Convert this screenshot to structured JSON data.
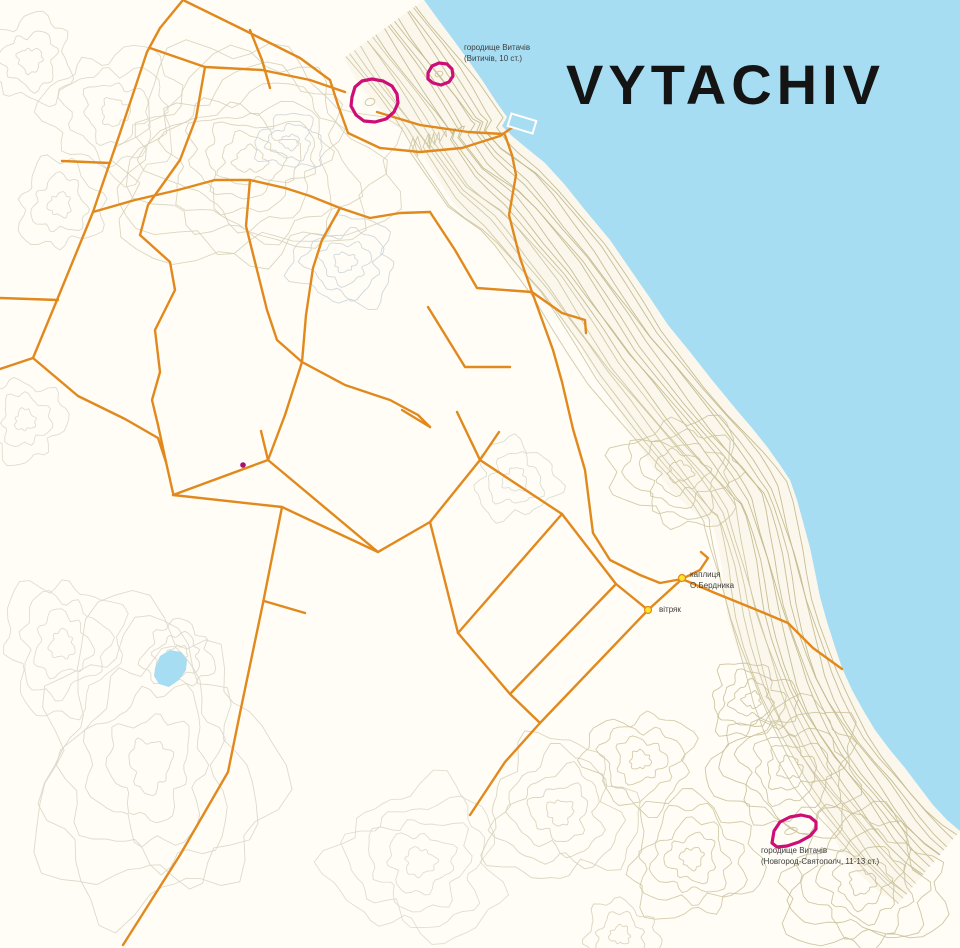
{
  "title": "VYTACHIV",
  "labels": {
    "site_north": {
      "line1": "городище Витачів",
      "line2": "(Витичів, 10 ст.)"
    },
    "chapel": {
      "line1": "каплиця",
      "line2": "О.Бердника"
    },
    "windmill": {
      "line1": "вітряк"
    },
    "site_south": {
      "line1": "городище Витачів",
      "line2": "(Новгород-Святополч, 11-13 ст.)"
    }
  },
  "colors": {
    "water": "#a7ddf2",
    "land": "#fffdf6",
    "coast_tint": "#f7f2e2",
    "contour_olive": "#c3ba8e",
    "contour_olive_light": "#cfc7a2",
    "road_orange": "#e1891d",
    "site_magenta": "#cc0e76",
    "poi_yellow": "#f9e62c",
    "dot_magenta": "#a8117a",
    "title_black": "#141414",
    "label_gray": "#3d3d3d"
  },
  "map": {
    "coast": [
      [
        424,
        0
      ],
      [
        437,
        18
      ],
      [
        452,
        38
      ],
      [
        468,
        60
      ],
      [
        482,
        80
      ],
      [
        497,
        103
      ],
      [
        507,
        117
      ],
      [
        502,
        126
      ],
      [
        512,
        136
      ],
      [
        524,
        146
      ],
      [
        545,
        163
      ],
      [
        565,
        185
      ],
      [
        585,
        210
      ],
      [
        610,
        240
      ],
      [
        632,
        272
      ],
      [
        650,
        298
      ],
      [
        668,
        325
      ],
      [
        690,
        352
      ],
      [
        712,
        380
      ],
      [
        735,
        408
      ],
      [
        752,
        428
      ],
      [
        768,
        448
      ],
      [
        780,
        465
      ],
      [
        790,
        480
      ],
      [
        797,
        500
      ],
      [
        803,
        522
      ],
      [
        810,
        548
      ],
      [
        815,
        572
      ],
      [
        820,
        597
      ],
      [
        827,
        622
      ],
      [
        835,
        647
      ],
      [
        842,
        668
      ],
      [
        852,
        690
      ],
      [
        863,
        710
      ],
      [
        875,
        730
      ],
      [
        890,
        750
      ],
      [
        905,
        768
      ],
      [
        920,
        788
      ],
      [
        933,
        805
      ],
      [
        947,
        820
      ],
      [
        960,
        831
      ]
    ],
    "pier": {
      "x": 509,
      "y": 117,
      "w": 26,
      "h": 13,
      "rot": 17
    },
    "lake": [
      [
        155,
        668
      ],
      [
        160,
        656
      ],
      [
        170,
        650
      ],
      [
        181,
        652
      ],
      [
        187,
        660
      ],
      [
        186,
        670
      ],
      [
        179,
        680
      ],
      [
        169,
        687
      ],
      [
        159,
        684
      ],
      [
        154,
        676
      ]
    ],
    "roads": [
      [
        [
          183,
          0
        ],
        [
          160,
          28
        ],
        [
          147,
          52
        ],
        [
          120,
          133
        ],
        [
          93,
          212
        ],
        [
          57,
          300
        ],
        [
          33,
          358
        ],
        [
          0,
          369
        ]
      ],
      [
        [
          33,
          358
        ],
        [
          78,
          396
        ],
        [
          125,
          419
        ],
        [
          158,
          438
        ],
        [
          166,
          462
        ],
        [
          173,
          493
        ]
      ],
      [
        [
          183,
          0
        ],
        [
          240,
          28
        ],
        [
          300,
          58
        ],
        [
          330,
          80
        ],
        [
          338,
          105
        ],
        [
          348,
          133
        ],
        [
          380,
          148
        ],
        [
          420,
          152
        ],
        [
          462,
          148
        ],
        [
          500,
          136
        ],
        [
          513,
          127
        ]
      ],
      [
        [
          377,
          112
        ],
        [
          420,
          125
        ],
        [
          468,
          132
        ],
        [
          503,
          134
        ]
      ],
      [
        [
          505,
          135
        ],
        [
          512,
          155
        ],
        [
          516,
          175
        ],
        [
          509,
          215
        ],
        [
          520,
          258
        ],
        [
          532,
          292
        ]
      ],
      [
        [
          150,
          48
        ],
        [
          205,
          67
        ],
        [
          262,
          70
        ],
        [
          310,
          80
        ],
        [
          345,
          92
        ]
      ],
      [
        [
          250,
          30
        ],
        [
          262,
          60
        ],
        [
          270,
          88
        ]
      ],
      [
        [
          205,
          67
        ],
        [
          196,
          118
        ],
        [
          180,
          160
        ],
        [
          148,
          205
        ],
        [
          140,
          235
        ],
        [
          170,
          262
        ],
        [
          175,
          290
        ],
        [
          155,
          330
        ],
        [
          160,
          372
        ],
        [
          152,
          400
        ],
        [
          158,
          425
        ],
        [
          166,
          462
        ]
      ],
      [
        [
          110,
          163
        ],
        [
          62,
          161
        ]
      ],
      [
        [
          58,
          300
        ],
        [
          0,
          298
        ]
      ],
      [
        [
          93,
          212
        ],
        [
          135,
          200
        ],
        [
          178,
          190
        ],
        [
          215,
          180
        ],
        [
          250,
          180
        ],
        [
          285,
          188
        ],
        [
          310,
          196
        ],
        [
          340,
          208
        ],
        [
          370,
          218
        ],
        [
          400,
          213
        ],
        [
          430,
          212
        ]
      ],
      [
        [
          250,
          180
        ],
        [
          246,
          226
        ],
        [
          257,
          270
        ],
        [
          267,
          310
        ],
        [
          277,
          340
        ],
        [
          302,
          362
        ]
      ],
      [
        [
          340,
          208
        ],
        [
          322,
          240
        ],
        [
          313,
          268
        ],
        [
          306,
          315
        ],
        [
          302,
          362
        ],
        [
          285,
          415
        ],
        [
          268,
          460
        ]
      ],
      [
        [
          302,
          362
        ],
        [
          345,
          385
        ],
        [
          390,
          400
        ],
        [
          418,
          415
        ],
        [
          430,
          427
        ]
      ],
      [
        [
          430,
          212
        ],
        [
          455,
          250
        ],
        [
          477,
          288
        ],
        [
          532,
          292
        ]
      ],
      [
        [
          532,
          292
        ],
        [
          562,
          313
        ],
        [
          585,
          320
        ],
        [
          586,
          333
        ]
      ],
      [
        [
          428,
          307
        ],
        [
          465,
          367
        ],
        [
          510,
          367
        ]
      ],
      [
        [
          402,
          410
        ],
        [
          430,
          427
        ]
      ],
      [
        [
          457,
          412
        ],
        [
          480,
          460
        ]
      ],
      [
        [
          532,
          292
        ],
        [
          553,
          350
        ],
        [
          562,
          382
        ],
        [
          573,
          429
        ],
        [
          585,
          470
        ],
        [
          593,
          533
        ],
        [
          610,
          560
        ],
        [
          640,
          575
        ],
        [
          660,
          583
        ],
        [
          682,
          579
        ]
      ],
      [
        [
          682,
          579
        ],
        [
          700,
          570
        ],
        [
          708,
          558
        ],
        [
          701,
          552
        ]
      ],
      [
        [
          682,
          579
        ],
        [
          715,
          593
        ],
        [
          757,
          610
        ],
        [
          788,
          623
        ],
        [
          813,
          648
        ],
        [
          842,
          669
        ]
      ],
      [
        [
          173,
          495
        ],
        [
          268,
          460
        ]
      ],
      [
        [
          268,
          460
        ],
        [
          378,
          552
        ]
      ],
      [
        [
          378,
          552
        ],
        [
          282,
          507
        ]
      ],
      [
        [
          282,
          507
        ],
        [
          173,
          495
        ]
      ],
      [
        [
          378,
          552
        ],
        [
          430,
          522
        ]
      ],
      [
        [
          430,
          522
        ],
        [
          480,
          460
        ]
      ],
      [
        [
          430,
          522
        ],
        [
          458,
          633
        ]
      ],
      [
        [
          480,
          460
        ],
        [
          562,
          514
        ]
      ],
      [
        [
          458,
          633
        ],
        [
          562,
          514
        ]
      ],
      [
        [
          562,
          514
        ],
        [
          616,
          584
        ]
      ],
      [
        [
          458,
          633
        ],
        [
          510,
          694
        ]
      ],
      [
        [
          510,
          694
        ],
        [
          616,
          584
        ]
      ],
      [
        [
          616,
          584
        ],
        [
          648,
          610
        ]
      ],
      [
        [
          510,
          694
        ],
        [
          540,
          723
        ]
      ],
      [
        [
          540,
          723
        ],
        [
          648,
          610
        ]
      ],
      [
        [
          648,
          610
        ],
        [
          682,
          579
        ]
      ],
      [
        [
          268,
          460
        ],
        [
          261,
          431
        ]
      ],
      [
        [
          480,
          460
        ],
        [
          499,
          432
        ]
      ],
      [
        [
          540,
          723
        ],
        [
          505,
          762
        ],
        [
          470,
          815
        ]
      ],
      [
        [
          282,
          507
        ],
        [
          263,
          603
        ],
        [
          240,
          713
        ],
        [
          228,
          772
        ],
        [
          180,
          855
        ],
        [
          123,
          945
        ]
      ],
      [
        [
          264,
          601
        ],
        [
          305,
          613
        ]
      ]
    ],
    "sites": [
      {
        "name": "site-outline-north-large",
        "points": [
          [
            352,
            97
          ],
          [
            355,
            87
          ],
          [
            362,
            81
          ],
          [
            372,
            79
          ],
          [
            383,
            81
          ],
          [
            392,
            86
          ],
          [
            397,
            94
          ],
          [
            398,
            103
          ],
          [
            394,
            112
          ],
          [
            386,
            119
          ],
          [
            375,
            122
          ],
          [
            364,
            121
          ],
          [
            356,
            115
          ],
          [
            351,
            106
          ]
        ]
      },
      {
        "name": "site-outline-north-small",
        "points": [
          [
            428,
            73
          ],
          [
            432,
            66
          ],
          [
            439,
            63
          ],
          [
            447,
            64
          ],
          [
            452,
            69
          ],
          [
            453,
            76
          ],
          [
            449,
            82
          ],
          [
            441,
            85
          ],
          [
            433,
            83
          ],
          [
            428,
            79
          ]
        ]
      },
      {
        "name": "site-outline-south",
        "points": [
          [
            772,
            843
          ],
          [
            774,
            831
          ],
          [
            780,
            822
          ],
          [
            790,
            817
          ],
          [
            801,
            815
          ],
          [
            810,
            817
          ],
          [
            816,
            822
          ],
          [
            816,
            829
          ],
          [
            810,
            836
          ],
          [
            799,
            842
          ],
          [
            787,
            846
          ],
          [
            777,
            847
          ]
        ]
      }
    ],
    "inner_rings": [
      {
        "cx": 370,
        "cy": 102,
        "rx": 5,
        "ry": 3.5,
        "rot": -15
      },
      {
        "cx": 439,
        "cy": 74,
        "rx": 4,
        "ry": 2.6,
        "rot": -20
      },
      {
        "cx": 791,
        "cy": 831,
        "rx": 6.5,
        "ry": 3,
        "rot": -18
      }
    ],
    "pois": [
      {
        "name": "chapel-marker",
        "x": 682,
        "y": 578
      },
      {
        "name": "windmill-marker",
        "x": 648,
        "y": 610
      }
    ],
    "dot": {
      "x": 243,
      "y": 465
    }
  }
}
